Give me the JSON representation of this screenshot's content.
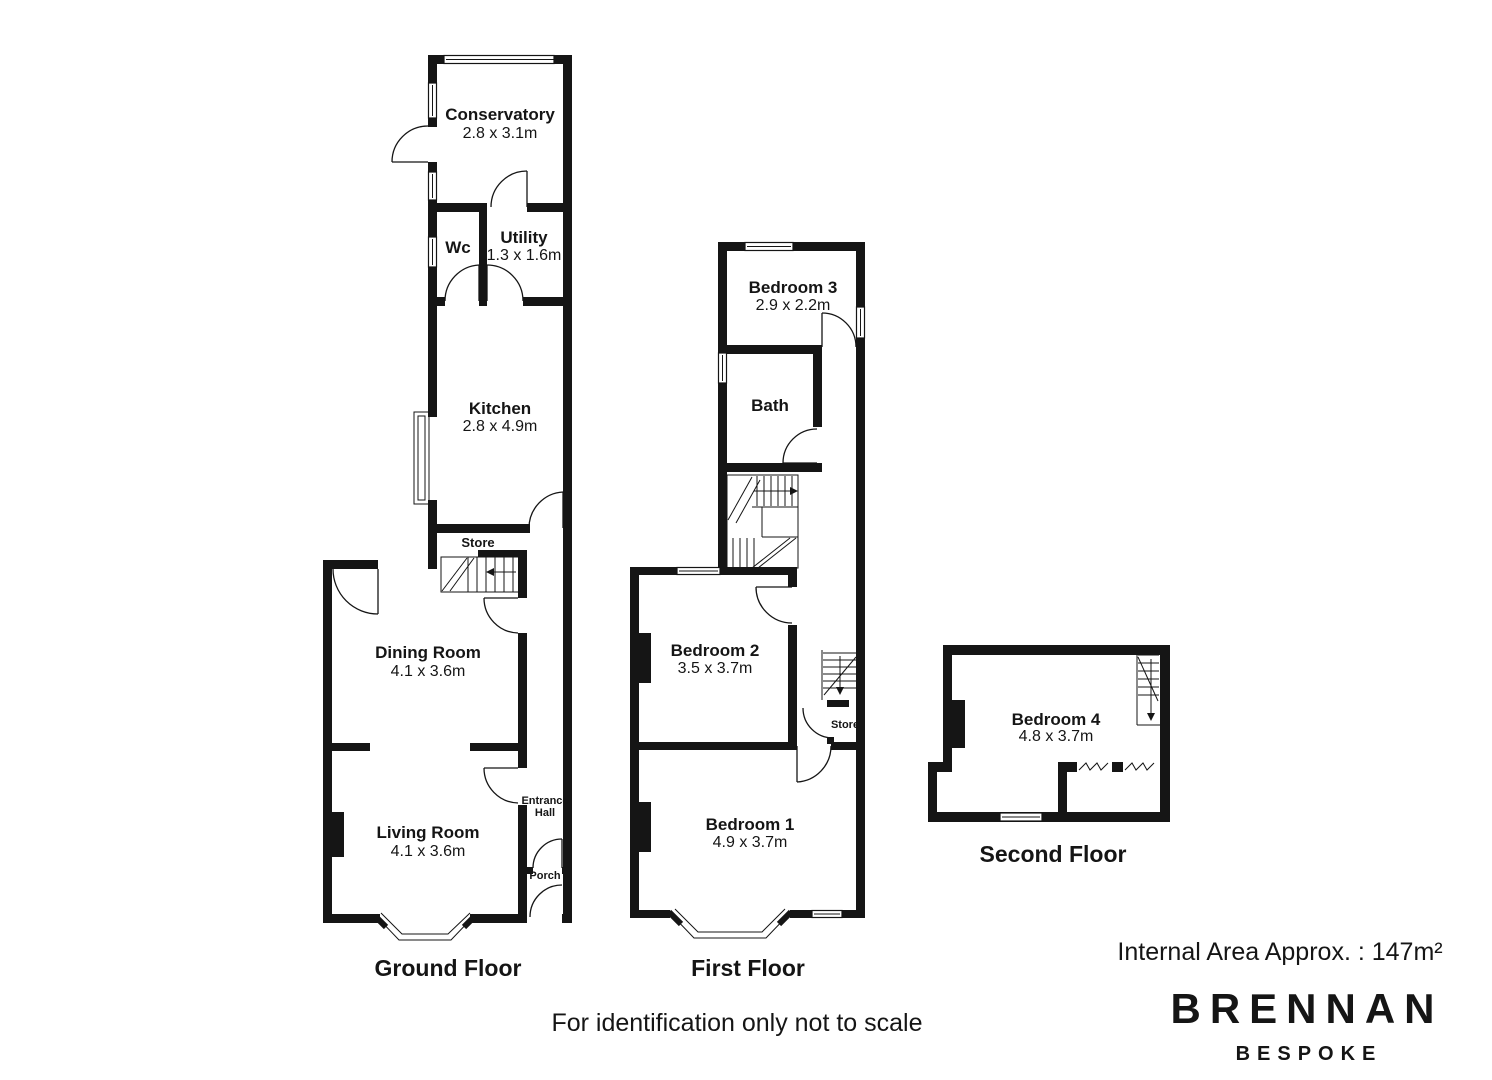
{
  "colors": {
    "wall": "#151515",
    "background": "#ffffff"
  },
  "floors": {
    "ground": {
      "title": "Ground Floor",
      "rooms": {
        "conservatory": {
          "name": "Conservatory",
          "dims": "2.8 x 3.1m"
        },
        "wc": {
          "name": "Wc"
        },
        "utility": {
          "name": "Utility",
          "dims": "1.3 x 1.6m"
        },
        "kitchen": {
          "name": "Kitchen",
          "dims": "2.8 x 4.9m"
        },
        "store": {
          "name": "Store"
        },
        "dining_room": {
          "name": "Dining Room",
          "dims": "4.1 x 3.6m"
        },
        "living_room": {
          "name": "Living Room",
          "dims": "4.1 x 3.6m"
        },
        "entrance_hall": {
          "line1": "Entrance",
          "line2": "Hall"
        },
        "porch": {
          "name": "Porch"
        }
      }
    },
    "first": {
      "title": "First Floor",
      "rooms": {
        "bedroom3": {
          "name": "Bedroom 3",
          "dims": "2.9 x 2.2m"
        },
        "bath": {
          "name": "Bath"
        },
        "bedroom2": {
          "name": "Bedroom 2",
          "dims": "3.5 x 3.7m"
        },
        "store": {
          "name": "Store"
        },
        "bedroom1": {
          "name": "Bedroom 1",
          "dims": "4.9 x 3.7m"
        }
      }
    },
    "second": {
      "title": "Second Floor",
      "rooms": {
        "bedroom4": {
          "name": "Bedroom 4",
          "dims": "4.8 x 3.7m"
        }
      }
    }
  },
  "footer": {
    "disclaimer": "For identification only not to scale",
    "area_note": "Internal Area Approx. : 147m²"
  },
  "brand": {
    "name": "BRENNAN",
    "tagline": "BESPOKE"
  }
}
